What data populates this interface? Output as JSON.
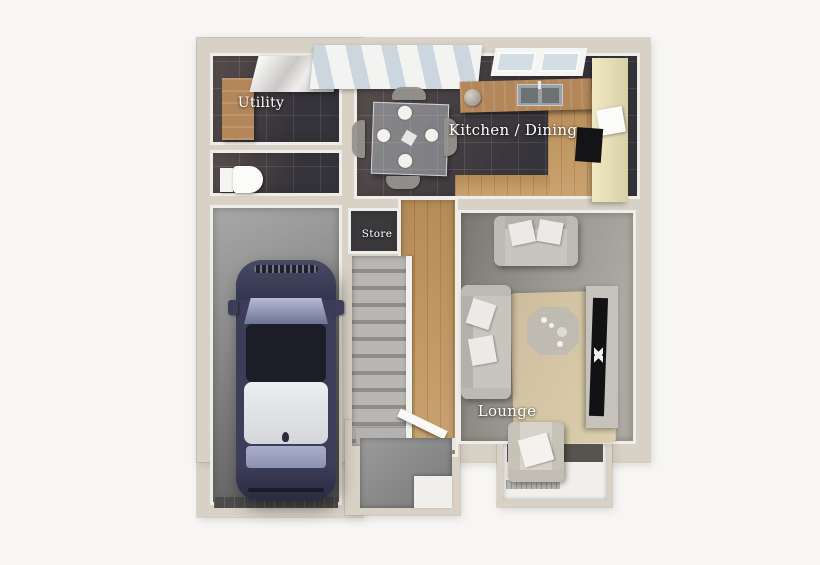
{
  "floor_plan": {
    "type": "3d-floorplan-top-down-render",
    "rooms": [
      {
        "name": "utility",
        "label": "Utility"
      },
      {
        "name": "kitchen-dining",
        "label": "Kitchen / Dining"
      },
      {
        "name": "store",
        "label": "Store"
      },
      {
        "name": "lounge",
        "label": "Lounge"
      }
    ],
    "unlabeled_areas": [
      "garage",
      "wc",
      "hallway",
      "staircase",
      "porch",
      "bay-window"
    ],
    "furniture": [
      "car",
      "dining-table",
      "kitchen-sink",
      "kitchen-counter",
      "kitchen-units",
      "oven",
      "coffee-maker",
      "sofa",
      "sofa",
      "coffee-table",
      "tv-unit",
      "armchair",
      "radiator",
      "toilet",
      "utility-counter",
      "utility-cabinets",
      "front-door",
      "bifold-doors",
      "rug"
    ],
    "colors": {
      "background": "#f7f6f4",
      "wall": "#d8d1c5",
      "wall_inner_face": "#efede9",
      "tile_floor": "#46434a",
      "wood_floor": "#c39a63",
      "carpet": "#a3a099",
      "rug": "#d3c4a6",
      "garage_floor": "#8a8a8a",
      "car_body": "#3c3d58",
      "car_roof": "#eceef1",
      "kitchen_units": "#ece4bd",
      "label_text": "#ffffff"
    }
  }
}
